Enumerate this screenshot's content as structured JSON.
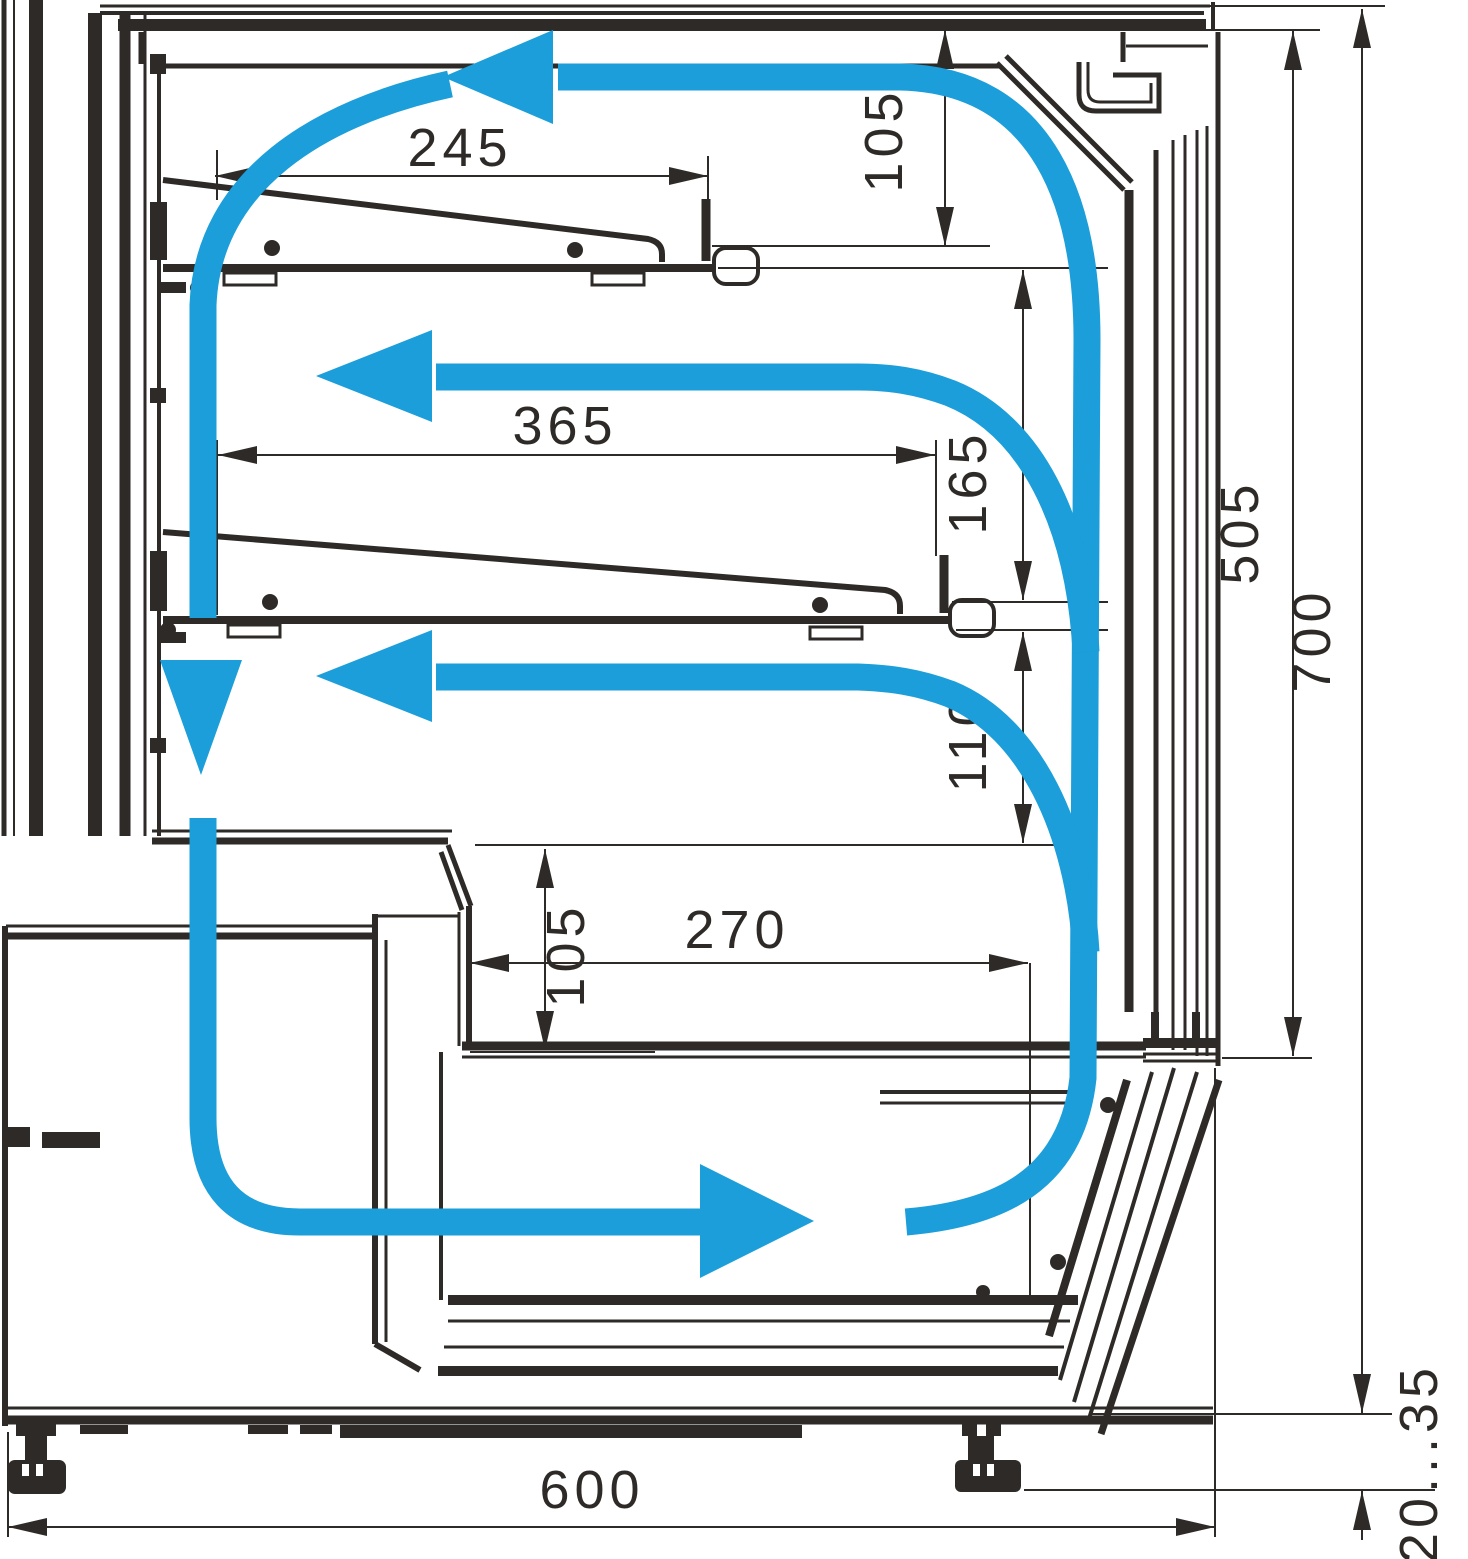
{
  "diagram": {
    "type": "technical-drawing",
    "subject": "refrigerated-display-case-cross-section-with-air-circulation",
    "units": "mm",
    "colors": {
      "line": "#2e2a27",
      "airflow": "#1b9ed9",
      "background": "#ffffff"
    },
    "dimensions": {
      "top_shelf_depth": "245",
      "canopy_air_gap": "105",
      "middle_shelf_depth": "365",
      "top_to_middle_shelf_gap": "165",
      "middle_shelf_to_step_gap": "110",
      "step_to_deck_gap": "105",
      "deck_depth": "270",
      "glass_opening_height": "505",
      "overall_height": "700",
      "overall_depth": "600",
      "leg_adjustment_range": "20...35"
    },
    "airflow": {
      "icon": "airflow-arrow-icon",
      "arrows": [
        "top-canopy-arrow-left",
        "middle-shelf-arrow-left",
        "lower-shelf-arrow-left",
        "back-duct-arrow-down",
        "bottom-well-arrow-right"
      ]
    }
  }
}
